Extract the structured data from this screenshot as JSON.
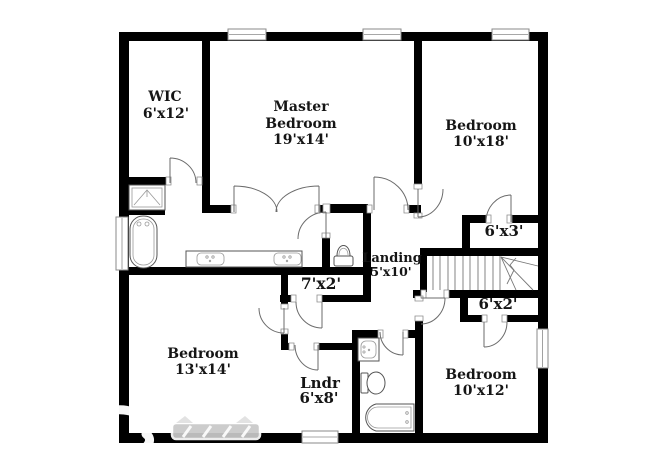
{
  "floor_plan": {
    "background_color": "#ffffff",
    "wall_color": "#000000",
    "rooms": [
      {
        "id": "wic",
        "name": "WIC",
        "dims": "6'x12'"
      },
      {
        "id": "master-bedroom",
        "name_line1": "Master",
        "name_line2": "Bedroom",
        "dims": "19'x14'"
      },
      {
        "id": "bedroom-upper-right",
        "name": "Bedroom",
        "dims": "10'x18'"
      },
      {
        "id": "closet-upper",
        "dims": "6'x3'"
      },
      {
        "id": "landing",
        "name": "Landing",
        "dims": "5'x10'"
      },
      {
        "id": "closet-hall",
        "dims": "7'x2'"
      },
      {
        "id": "closet-lower",
        "dims": "6'x2'"
      },
      {
        "id": "bedroom-lower-left",
        "name": "Bedroom",
        "dims": "13'x14'"
      },
      {
        "id": "laundry",
        "name": "Lndr",
        "dims": "6'x8'"
      },
      {
        "id": "bedroom-lower-right",
        "name": "Bedroom",
        "dims": "10'x12'"
      }
    ],
    "fixtures": [
      "shower",
      "bathtub",
      "double-vanity",
      "toilet",
      "vanity",
      "toilet",
      "bathtub",
      "staircase"
    ],
    "watermark": {
      "visible": true
    }
  }
}
